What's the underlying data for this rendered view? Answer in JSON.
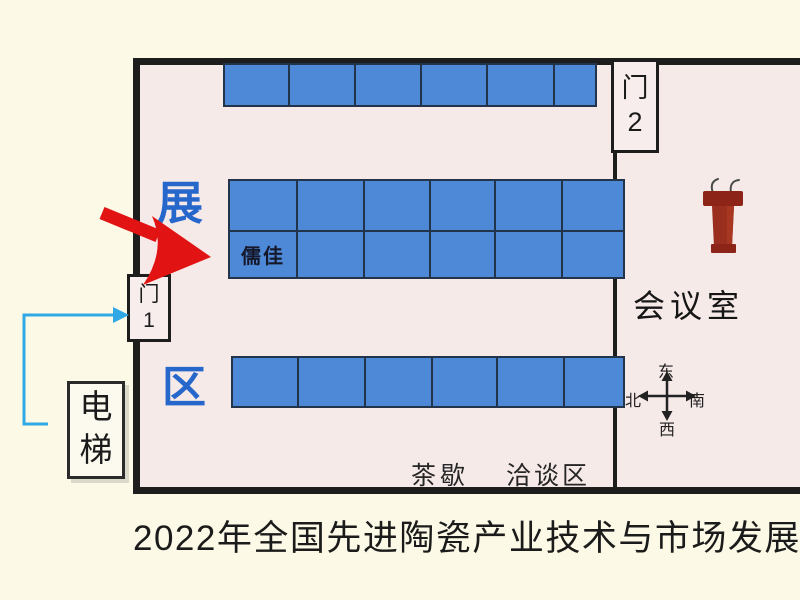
{
  "colors": {
    "bg": "#FCFAE6",
    "floor": "#F6EAE9",
    "wall": "#1d1d1d",
    "booth_fill": "#4E89D7",
    "booth_line": "#22334a",
    "zone_blue": "#2667CC",
    "route_blue": "#2FA8E5",
    "arrow_red": "#E21313",
    "podium_red": "#9B2F1F",
    "podium_dark": "#8C2418",
    "text_dark": "#1b1b1b"
  },
  "caption": {
    "text": "2022年全国先进陶瓷产业技术与市场发展"
  },
  "plan": {
    "zone_label_top": "展",
    "zone_label_bottom": "区",
    "booth_label": "儒佳",
    "meeting_room_label": "会议室",
    "tea_break_label": "茶歇",
    "negotiation_label": "洽谈区",
    "door1": {
      "char": "门",
      "num": "1"
    },
    "door2": {
      "char": "门",
      "num": "2"
    },
    "elevator": {
      "char1": "电",
      "char2": "梯"
    },
    "compass": {
      "top": "东",
      "right": "南",
      "bottom": "西",
      "left": "北"
    },
    "booth_blocks": [
      {
        "id": "top-row",
        "left": 223,
        "top": 63,
        "col_widths": [
          63,
          64,
          64,
          64,
          65,
          40
        ],
        "row_heights": [
          40
        ]
      },
      {
        "id": "middle-block",
        "left": 228,
        "top": 179,
        "col_widths": [
          66,
          65,
          64,
          63,
          65,
          60
        ],
        "row_heights": [
          49,
          45
        ],
        "label": {
          "row": 1,
          "col": 0
        }
      },
      {
        "id": "bottom-row",
        "left": 231,
        "top": 356,
        "col_widths": [
          64,
          65,
          65,
          63,
          65,
          58
        ],
        "row_heights": [
          48
        ]
      }
    ]
  }
}
